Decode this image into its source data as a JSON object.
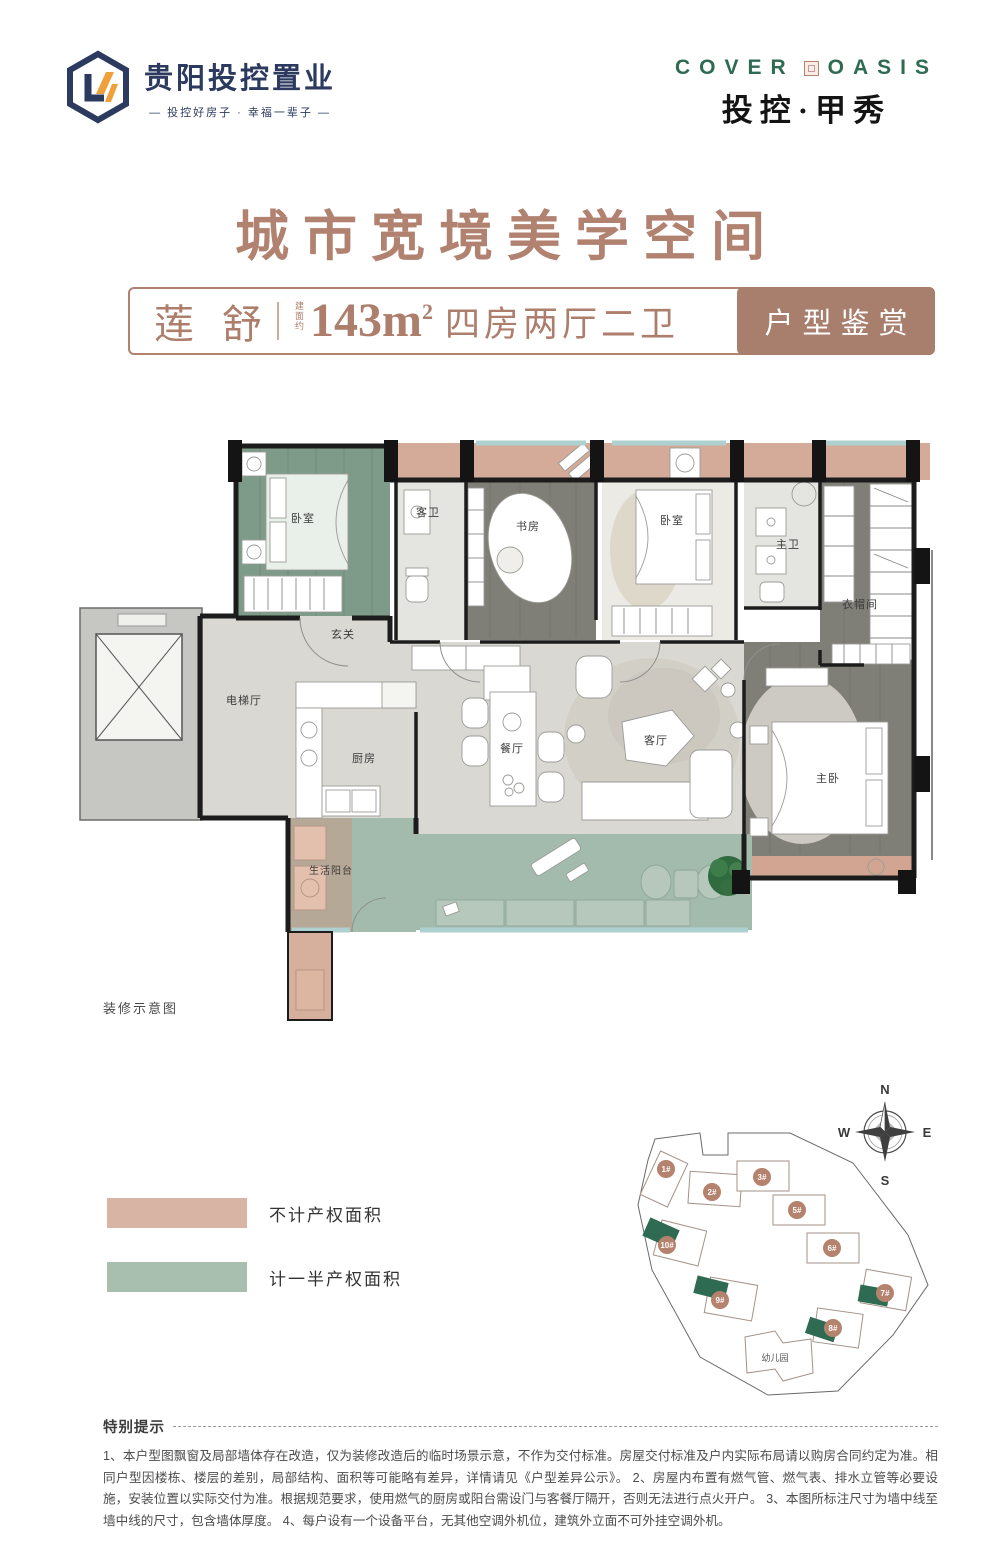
{
  "header": {
    "logo": {
      "name": "贵阳投控置业",
      "tagline": "— 投控好房子 · 幸福一辈子 —"
    },
    "brand": {
      "en_left": "COVER",
      "en_right": "OASIS",
      "cn": "投控·甲秀"
    }
  },
  "title": "城市宽境美学空间",
  "unit_bar": {
    "name": "莲 舒",
    "area_prefix": "建面约",
    "area_value": "143m",
    "area_sup": "2",
    "layout": "四房两厅二卫",
    "badge": "户型鉴赏"
  },
  "floorplan": {
    "note": "装修示意图",
    "rooms": {
      "bedroom_a": "卧室",
      "guest_bath": "客卫",
      "study": "书房",
      "bedroom_b": "卧室",
      "master_bath": "主卫",
      "cloakroom": "衣帽间",
      "foyer": "玄关",
      "elevator_hall": "电梯厅",
      "kitchen": "厨房",
      "dining": "餐厅",
      "living": "客厅",
      "master_bedroom": "主卧",
      "service_balcony": "生活阳台"
    }
  },
  "legend": {
    "items": [
      {
        "label": "不计产权面积",
        "color": "#d7b4a4"
      },
      {
        "label": "计一半产权面积",
        "color": "#a8bfaf"
      }
    ]
  },
  "compass": {
    "n": "N",
    "e": "E",
    "s": "S",
    "w": "W"
  },
  "site_plan": {
    "buildings": [
      {
        "label": "1#",
        "highlighted": false
      },
      {
        "label": "2#",
        "highlighted": false
      },
      {
        "label": "3#",
        "highlighted": false
      },
      {
        "label": "5#",
        "highlighted": false
      },
      {
        "label": "6#",
        "highlighted": false
      },
      {
        "label": "10#",
        "highlighted": true
      },
      {
        "label": "9#",
        "highlighted": true
      },
      {
        "label": "8#",
        "highlighted": true
      },
      {
        "label": "7#",
        "highlighted": true
      }
    ],
    "kindergarten": "幼儿园"
  },
  "footer": {
    "title": "特别提示",
    "body": "1、本户型图飘窗及局部墙体存在改造，仅为装修改造后的临时场景示意，不作为交付标准。房屋交付标准及户内实际布局请以购房合同约定为准。相同户型因楼栋、楼层的差别，局部结构、面积等可能略有差异，详情请见《户型差异公示》。 2、房屋内布置有燃气管、燃气表、排水立管等必要设施，安装位置以实际交付为准。根据规范要求，使用燃气的厨房或阳台需设门与客餐厅隔开，否则无法进行点火开户。 3、本图所标注尺寸为墙中线至墙中线的尺寸，包含墙体厚度。 4、每户设有一个设备平台，无其他空调外机位，建筑外立面不可外挂空调外机。"
  },
  "colors": {
    "brand_navy": "#2b3a5e",
    "brand_orange": "#efa03a",
    "brand_green": "#2e6b52",
    "title_brown": "#b28270",
    "badge_fill": "#a87e6d",
    "nonproperty_pink": "#c9957f",
    "half_property_green": "#a3bbac",
    "wall_black": "#1c1c1c",
    "floor_gray": "#d9d8d3",
    "wood_dark": "#7f7e77",
    "bedroom_green": "#7e9b8a"
  }
}
